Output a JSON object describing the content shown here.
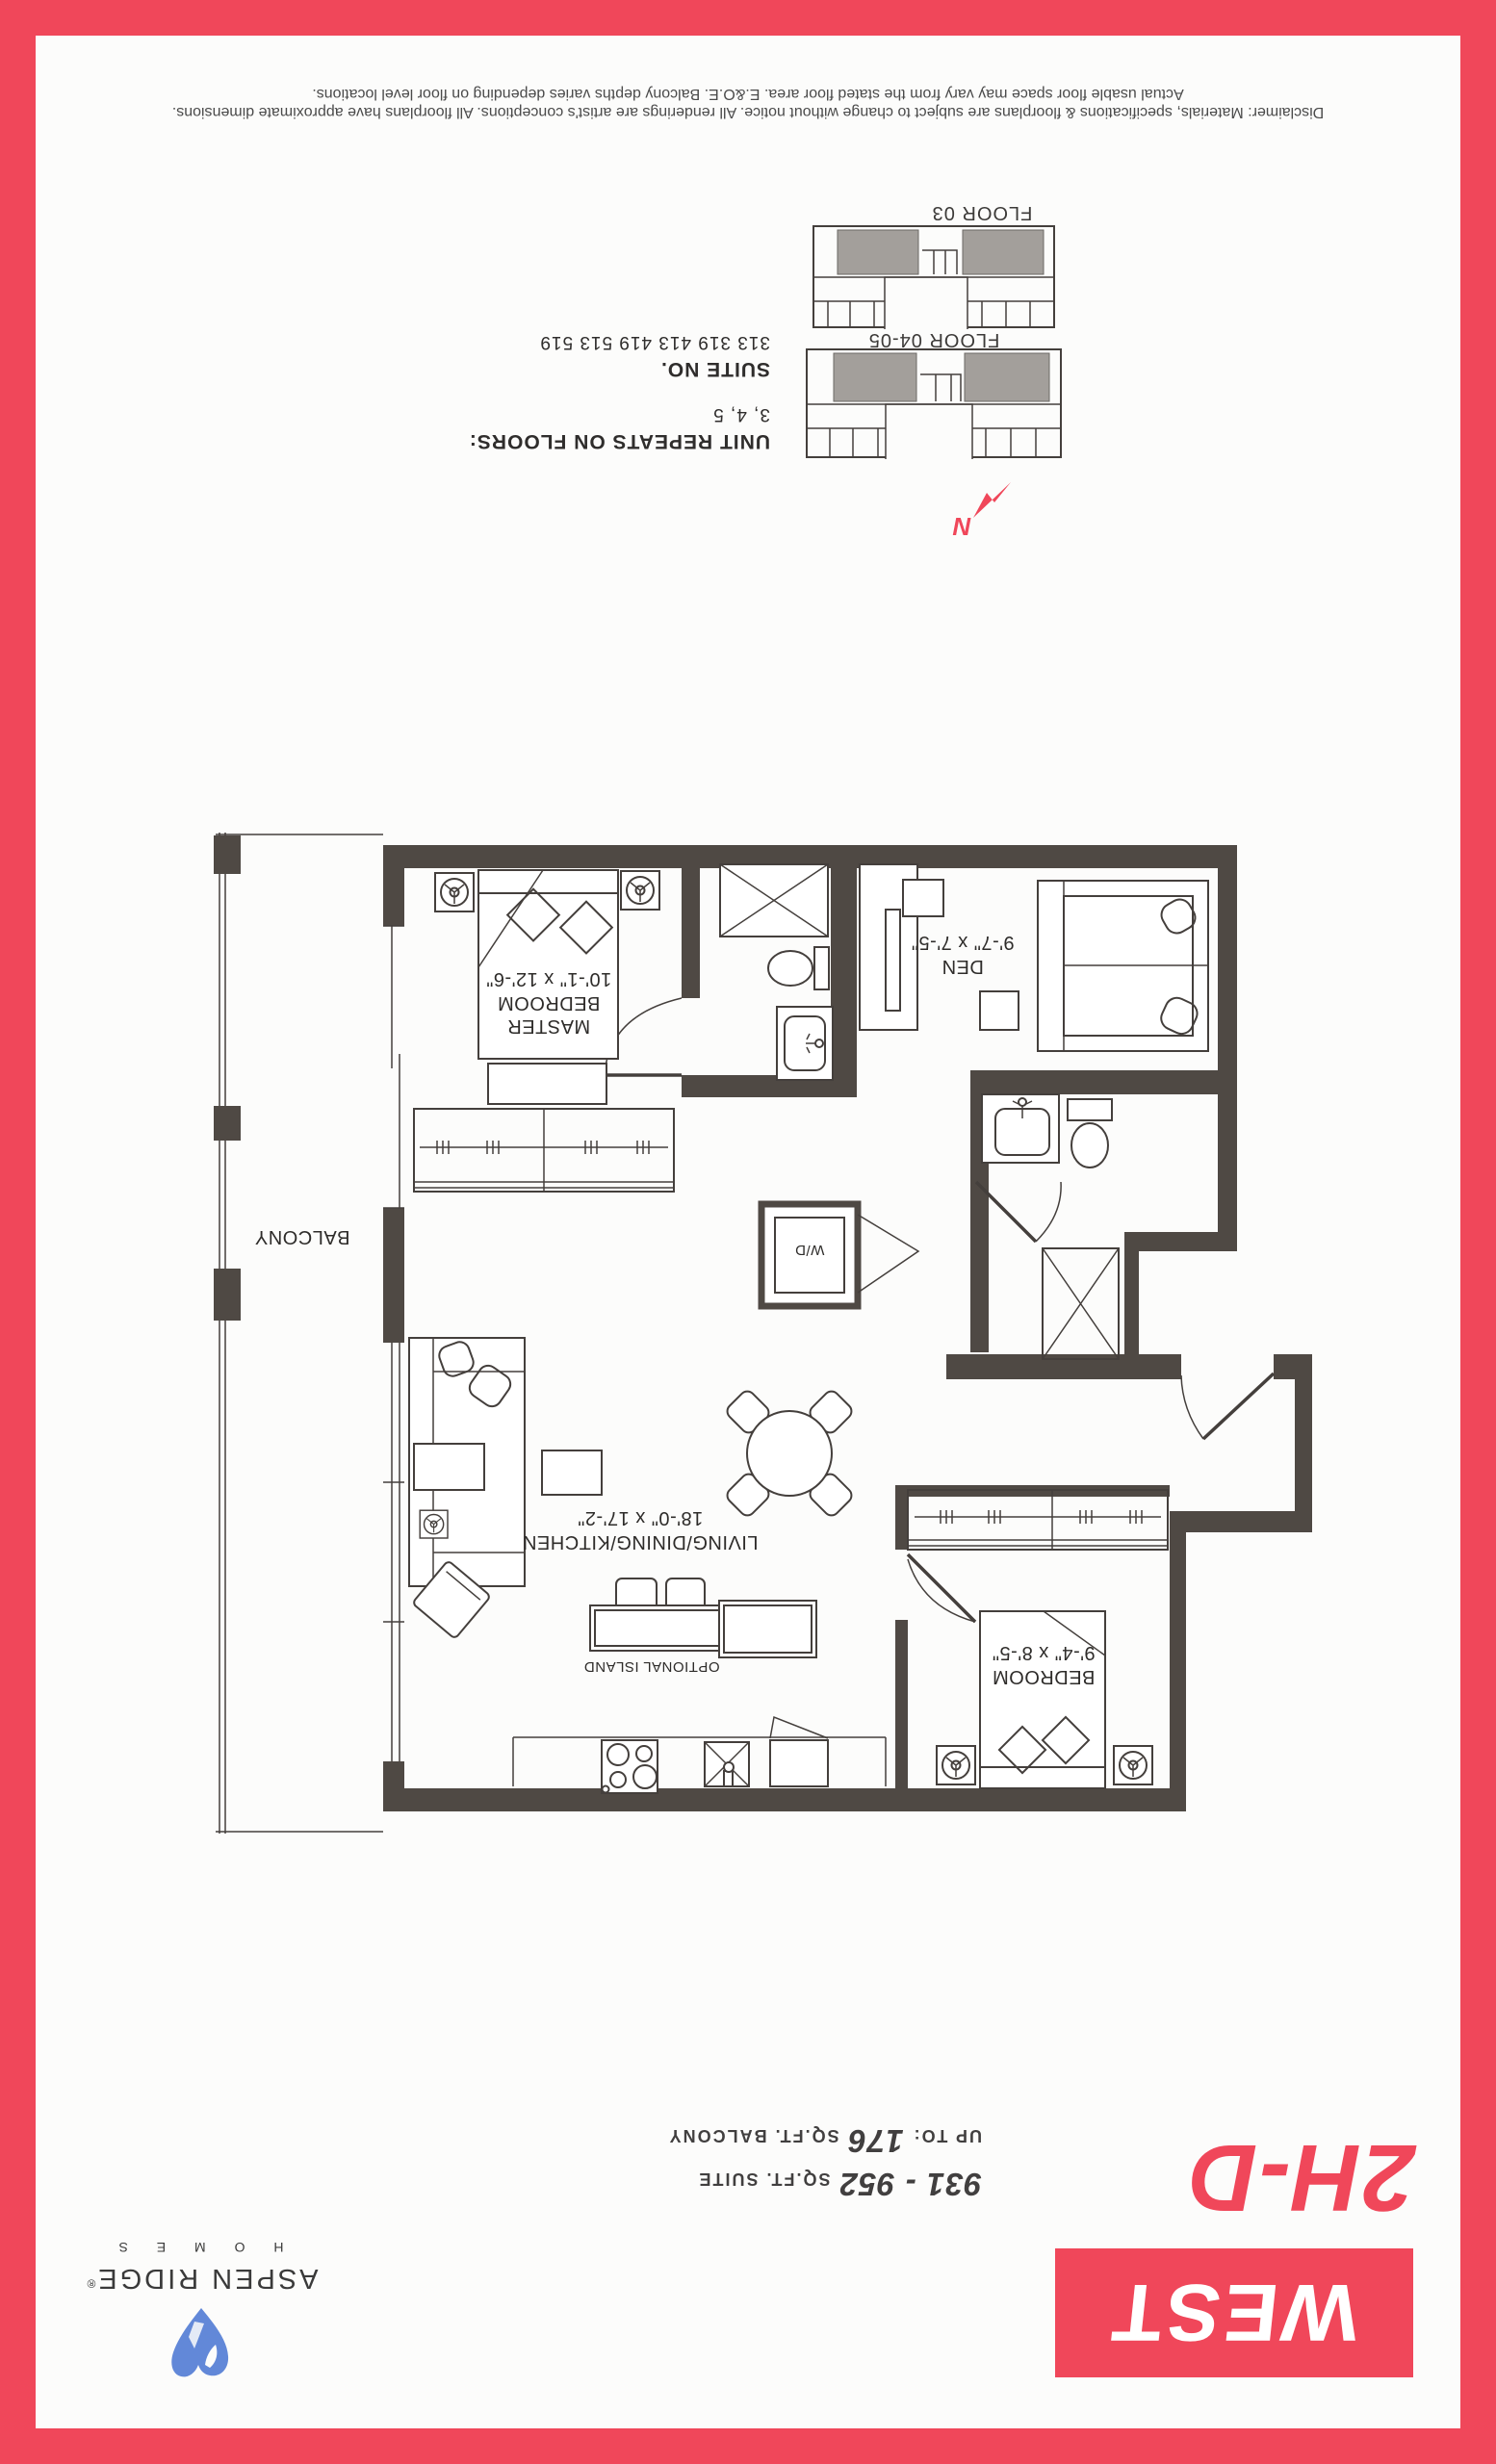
{
  "branding": {
    "project": "WEST",
    "plan_code": "2H-D",
    "suite_sqft": "931 - 952",
    "suite_sqft_label": "SQ.FT. SUITE",
    "balcony_prefix": "UP TO:",
    "balcony_sqft": "176",
    "balcony_sqft_label": "SQ.FT. BALCONY",
    "builder_name": "ASPEN RIDGE",
    "builder_reg": "®",
    "builder_sub": "H O M E S"
  },
  "plan": {
    "rooms": {
      "master": {
        "line1": "MASTER",
        "line2": "BEDROOM",
        "dims": "10'-1\" x 12'-6\""
      },
      "den": {
        "name": "DEN",
        "dims": "9'-7\" x 7'-5\""
      },
      "living": {
        "name": "LIVING/DINING/KITCHEN",
        "dims": "18'-0\" x 17'-2\""
      },
      "bedroom": {
        "name": "BEDROOM",
        "dims": "9'-4\" x 8'-5\""
      }
    },
    "balcony_label": "BALCONY",
    "washer_dryer": "W/D",
    "optional_island": "OPTIONAL ISLAND"
  },
  "keyplans": {
    "upper_label": "FLOOR 04-05",
    "lower_label": "FLOOR 03"
  },
  "suite_info": {
    "repeats_label": "UNIT REPEATS ON FLOORS:",
    "repeats_value": "3, 4, 5",
    "suite_no_label": "SUITE NO.",
    "suite_no_value": "313 319 413 419 513 519"
  },
  "compass": {
    "north": "N"
  },
  "disclaimer": {
    "line1": "Disclaimer: Materials, specifications & floorplans are subject to change without notice. All renderings are artist's conceptions. All floorplans have approximate dimensions.",
    "line2": "Actual usable floor space may vary from the stated floor area. E.&O.E. Balcony depths varies depending on floor level locations."
  },
  "colors": {
    "accent_red": "#f0475a",
    "wall_dark": "#4f4944",
    "keyplan_gray": "#a39f9b",
    "logo_blue": "#6288d8",
    "text_dark": "#3a3a3a"
  }
}
